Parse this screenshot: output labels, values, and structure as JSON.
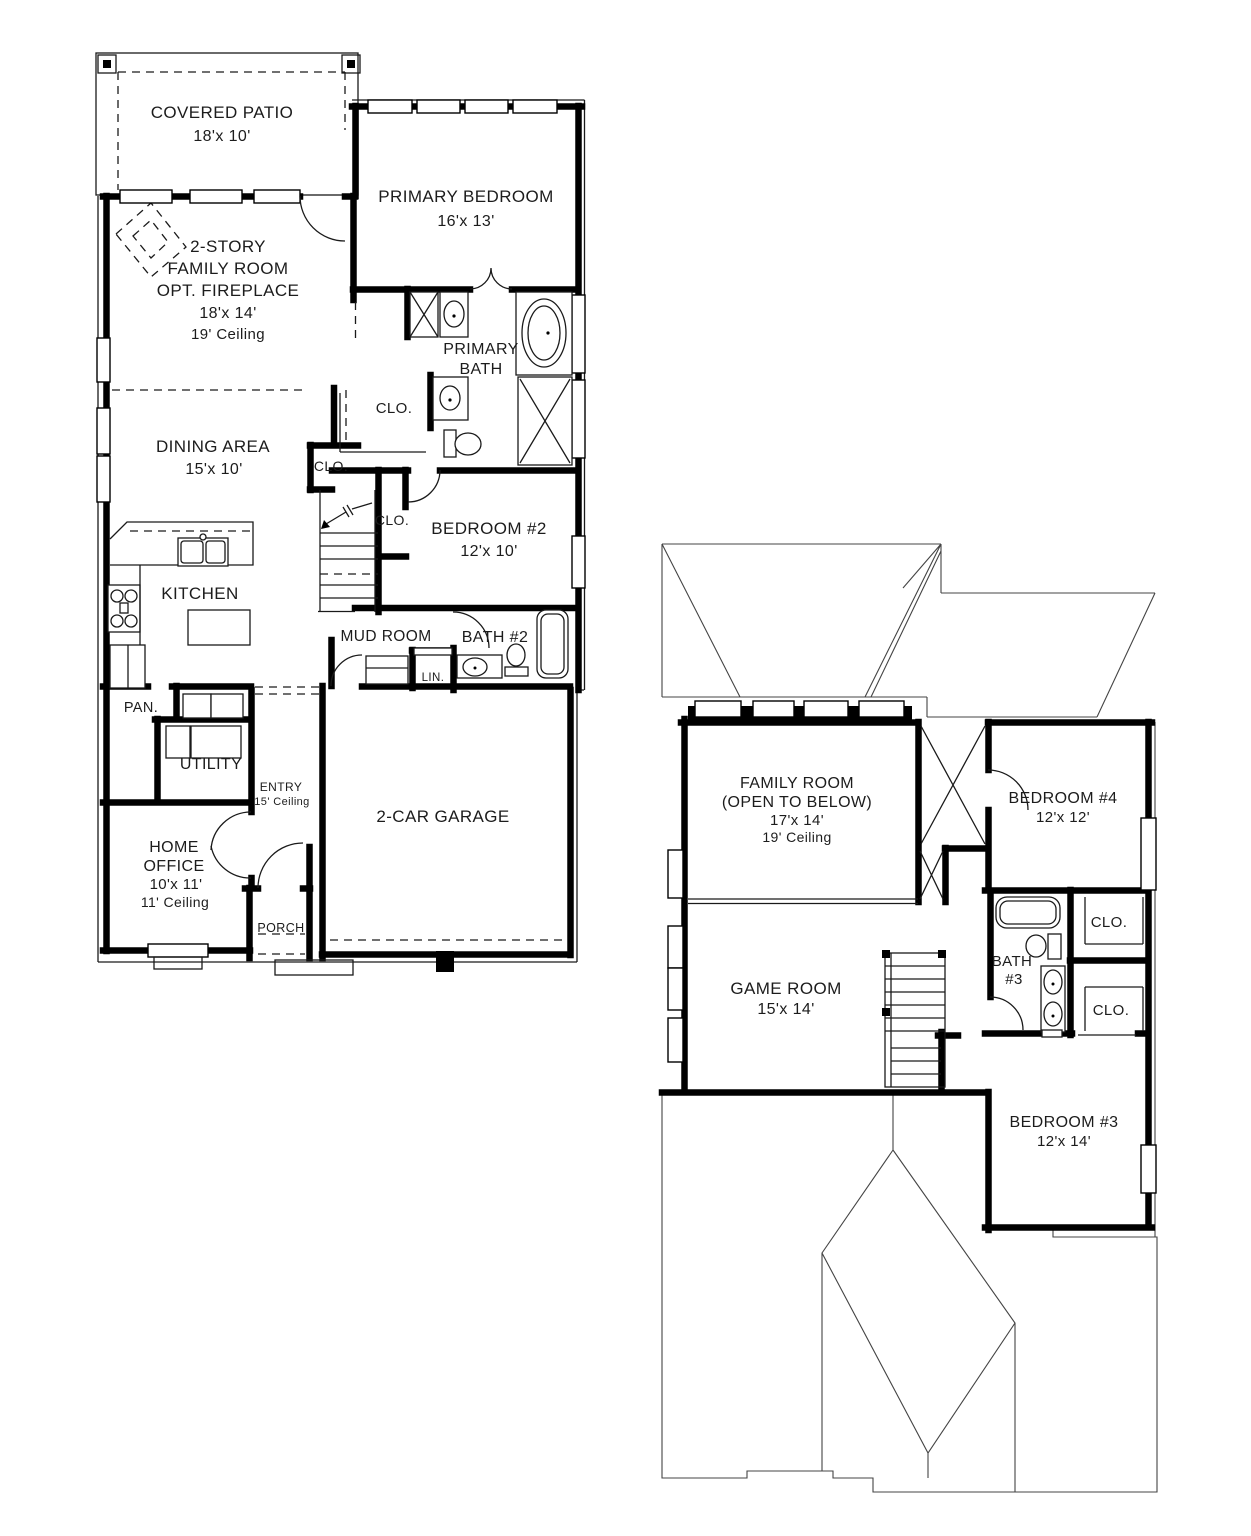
{
  "document": {
    "type": "residential floor plan",
    "background": "#ffffff",
    "wall_color": "#000000",
    "text_color": "#1c1c1c"
  },
  "floor1": {
    "name": "first-floor",
    "labels": {
      "covered_patio": [
        "COVERED PATIO",
        "18'x 10'"
      ],
      "primary_bedroom": [
        "PRIMARY BEDROOM",
        "16'x 13'"
      ],
      "family_room": [
        "2-STORY",
        "FAMILY ROOM",
        "OPT. FIREPLACE",
        "18'x 14'",
        "19' Ceiling"
      ],
      "primary_bath": [
        "PRIMARY",
        "BATH"
      ],
      "closet_primary": [
        "CLO."
      ],
      "dining": [
        "DINING AREA",
        "15'x 10'"
      ],
      "closet_hall": [
        "CLO."
      ],
      "closet_bed2": [
        "CLO."
      ],
      "bedroom2": [
        "BEDROOM #2",
        "12'x 10'"
      ],
      "kitchen": [
        "KITCHEN"
      ],
      "mud_room": [
        "MUD ROOM"
      ],
      "bath2": [
        "BATH #2"
      ],
      "linen": [
        "LIN."
      ],
      "pantry": [
        "PAN."
      ],
      "utility": [
        "UTILITY"
      ],
      "entry": [
        "ENTRY",
        "15' Ceiling"
      ],
      "home_office": [
        "HOME",
        "OFFICE",
        "10'x 11'",
        "11' Ceiling"
      ],
      "porch": [
        "PORCH"
      ],
      "garage": [
        "2-CAR GARAGE"
      ]
    }
  },
  "floor2": {
    "name": "second-floor",
    "labels": {
      "family_room_open": [
        "FAMILY ROOM",
        "(OPEN TO BELOW)",
        "17'x 14'",
        "19' Ceiling"
      ],
      "bedroom4": [
        "BEDROOM #4",
        "12'x 12'"
      ],
      "game_room": [
        "GAME ROOM",
        "15'x 14'"
      ],
      "bath3": [
        "BATH",
        "#3"
      ],
      "closet_top": [
        "CLO."
      ],
      "closet_bottom": [
        "CLO."
      ],
      "bedroom3": [
        "BEDROOM #3",
        "12'x 14'"
      ]
    }
  }
}
